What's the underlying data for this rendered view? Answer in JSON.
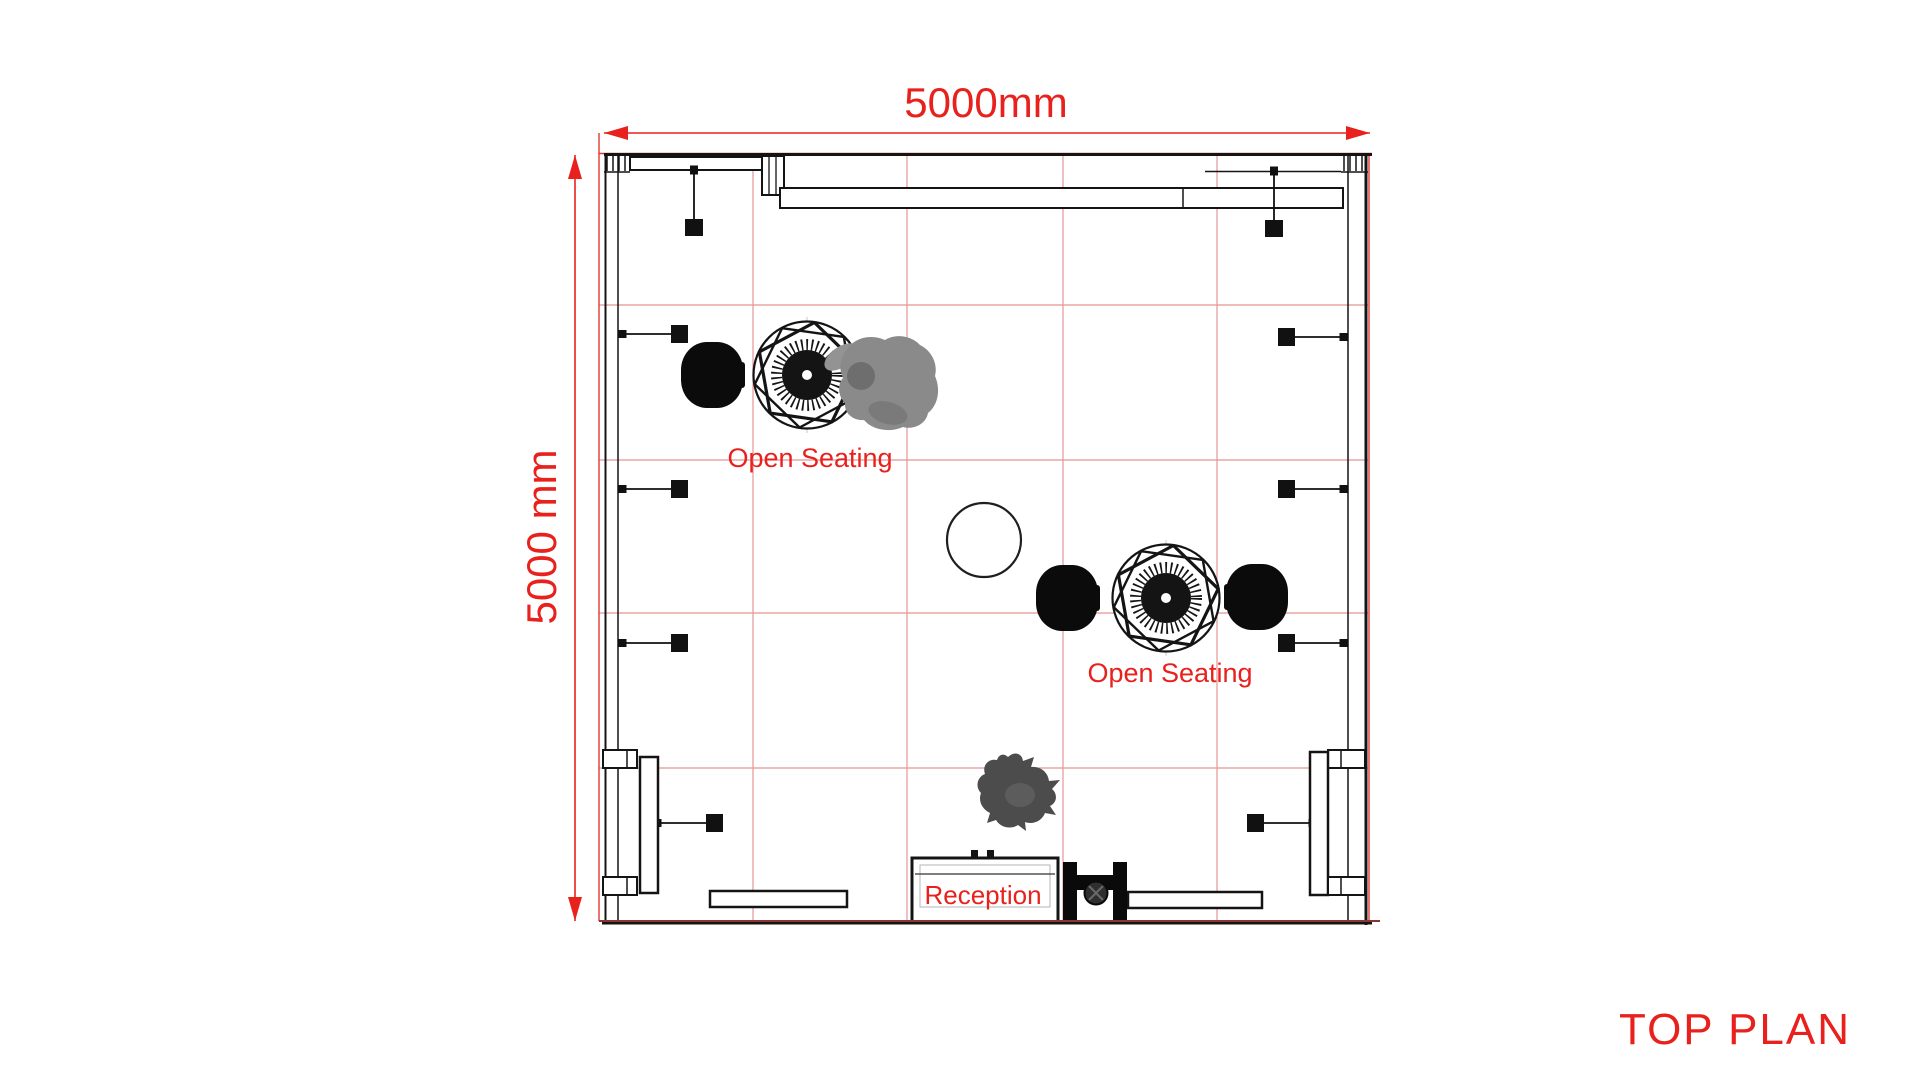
{
  "page": {
    "background": "#ffffff"
  },
  "colors": {
    "accent_red": "#e8211d",
    "grid_red": "#e59595",
    "grid_border_red": "#e03a30",
    "floor_edge_red": "#8a3531",
    "line_black": "#141414",
    "figure_gray": "#8a8a8a",
    "figure_dark_gray": "#4c4c4c"
  },
  "dimensions": {
    "width_label": "5000mm",
    "depth_label": "5000 mm"
  },
  "labels": {
    "open_seating_1": "Open Seating",
    "open_seating_2": "Open Seating",
    "reception": "Reception",
    "view_title": "TOP PLAN"
  },
  "legend": {
    "furniture_icons": [
      {
        "name": "round-patterned-table-icon",
        "count": 2
      },
      {
        "name": "lounge-chair-icon",
        "count": 3
      },
      {
        "name": "spotlight-fixture-icon",
        "count": 10
      },
      {
        "name": "reception-desk-icon",
        "count": 1
      },
      {
        "name": "bench-icon",
        "count": 2
      },
      {
        "name": "display-panel-icon",
        "count": 2
      },
      {
        "name": "round-rug-icon",
        "count": 1
      },
      {
        "name": "person-figure-icon",
        "count": 2
      }
    ]
  }
}
